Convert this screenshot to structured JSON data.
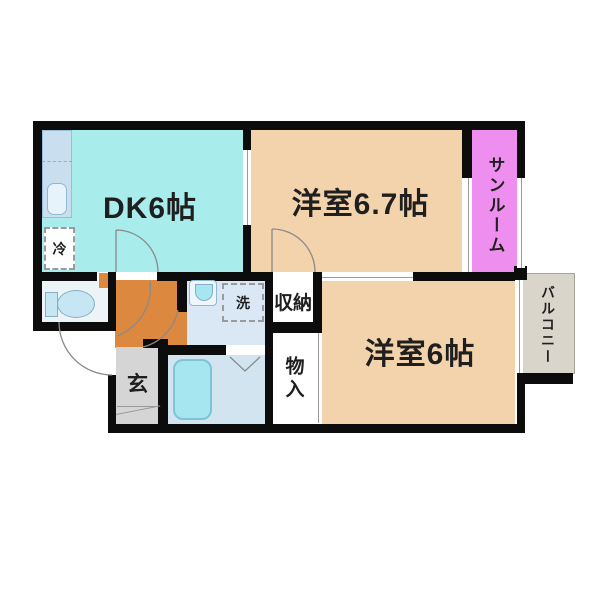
{
  "floorplan": {
    "wall_color": "#0c0c0c",
    "text_color": "#1f1f1f",
    "rooms": {
      "dk": {
        "label": "DK6帖",
        "color": "#a8ecec"
      },
      "bedroom1": {
        "label": "洋室6.7帖",
        "color": "#f3d3ac"
      },
      "bedroom2": {
        "label": "洋室6帖",
        "color": "#f3d3ac"
      },
      "sunroom": {
        "label": "サンルーム",
        "color": "#ee8eee"
      },
      "balcony": {
        "label": "バルコニー",
        "color": "#dad5cb"
      },
      "storage": {
        "label": "収納",
        "color": "#ffffff"
      },
      "closet": {
        "label": "物入",
        "color": "#ffffff"
      },
      "entrance": {
        "label": "玄",
        "color": "#d5d5d5"
      },
      "hallway": {
        "color": "#dd883f"
      },
      "washroom": {
        "color": "#d9e8f4"
      },
      "bathroom": {
        "color": "#d2e4f0"
      },
      "toilet_room": {
        "color": "#edf4f8"
      }
    },
    "fixtures": {
      "fridge": {
        "label": "冷"
      },
      "washer": {
        "label": "洗"
      }
    }
  }
}
